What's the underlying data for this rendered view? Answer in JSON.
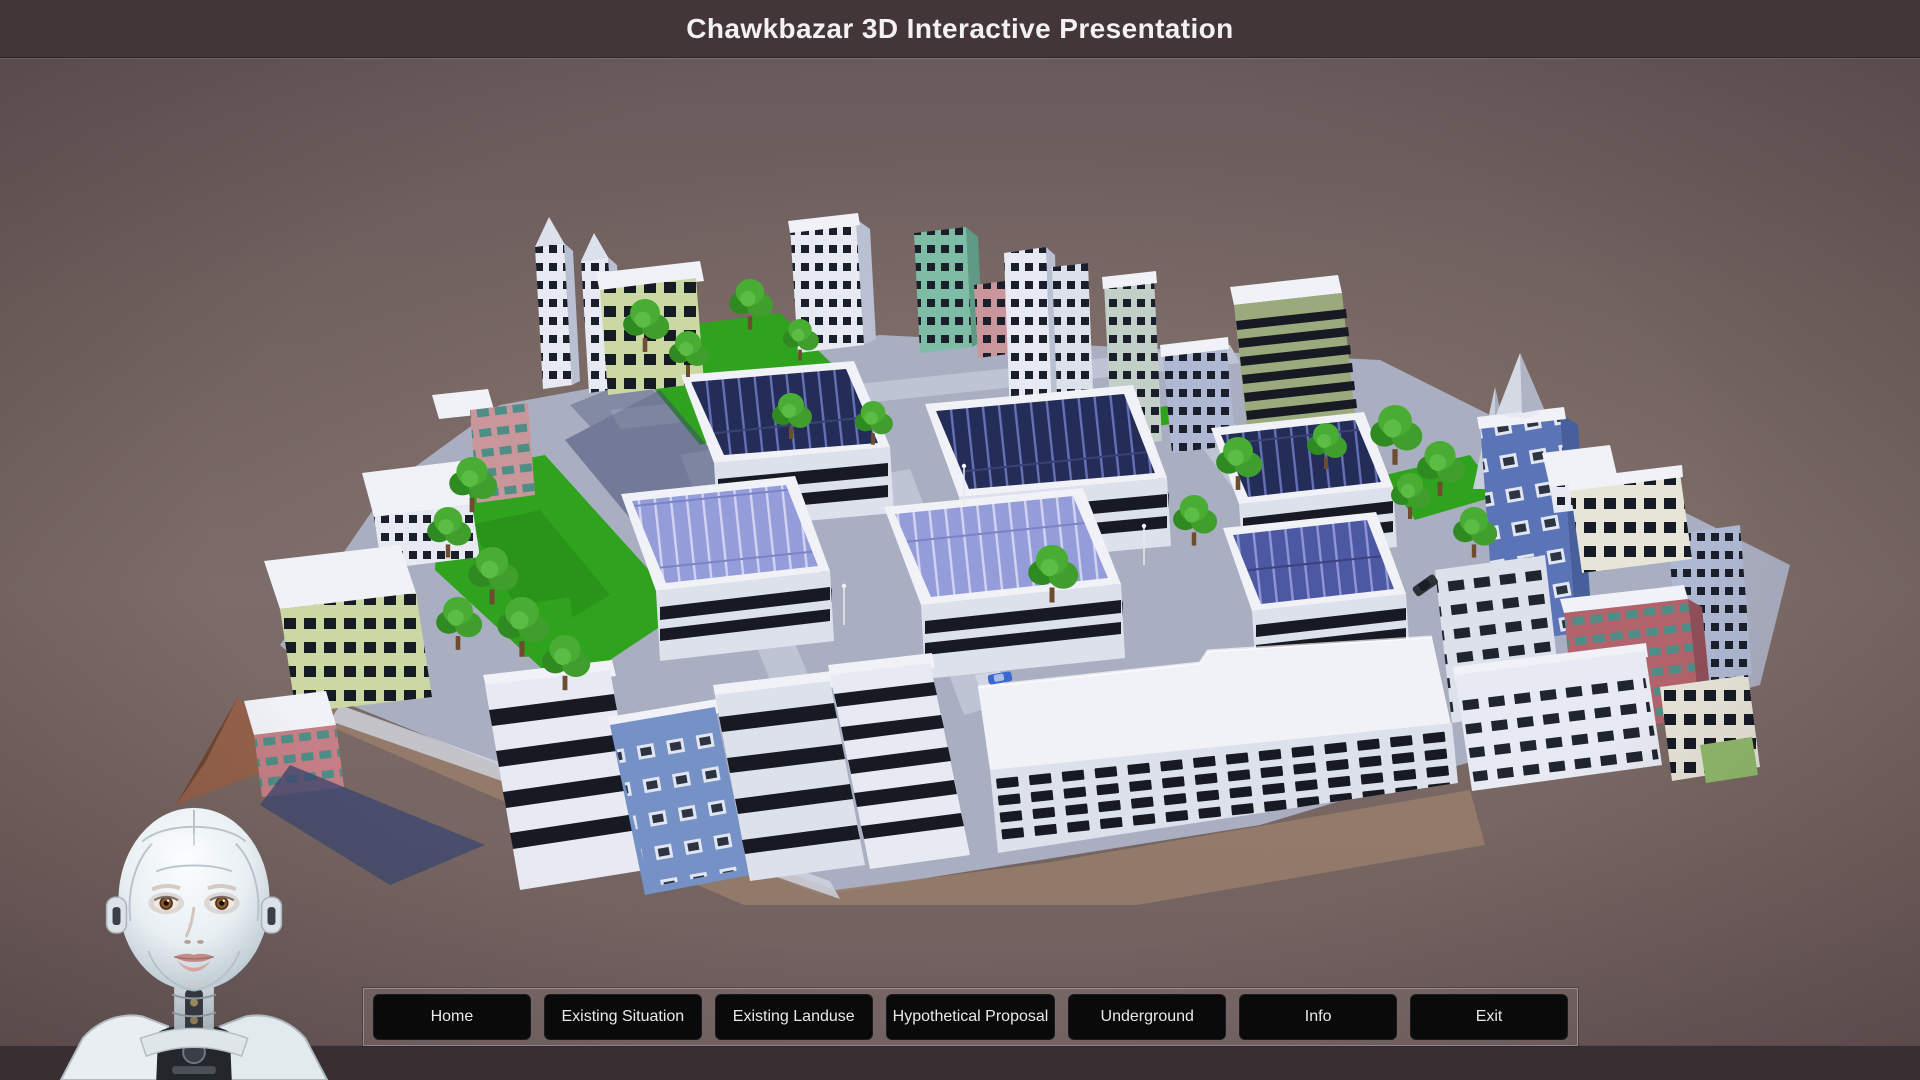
{
  "window": {
    "title": "Chawkbazar 3D Interactive Presentation"
  },
  "menu": {
    "buttons": [
      {
        "label": "Home"
      },
      {
        "label": "Existing Situation"
      },
      {
        "label": "Existing Landuse"
      },
      {
        "label": "Hypothetical Proposal"
      },
      {
        "label": "Underground"
      },
      {
        "label": "Info"
      },
      {
        "label": "Exit"
      }
    ]
  },
  "scene": {
    "model_name": "Chawkbazar urban block 3D model",
    "colors": {
      "title_bar": "#423639",
      "title_text": "#f3f1f2",
      "background_top": "#6a5b5d",
      "background_mid": "#7d6c68",
      "bottom_strip": "#392e31",
      "menu_button_bg": "#0a0a0b",
      "menu_button_text": "#e9e9ec",
      "menu_panel_border": "#baacb0",
      "solar_roof_dark": "#242c58",
      "solar_roof_light": "#959cda",
      "lawn_green": "#2fa31e",
      "road_gray": "#a9aec0",
      "building_white": "#e7eaf2",
      "tree_green": "#3f9e2c"
    }
  }
}
